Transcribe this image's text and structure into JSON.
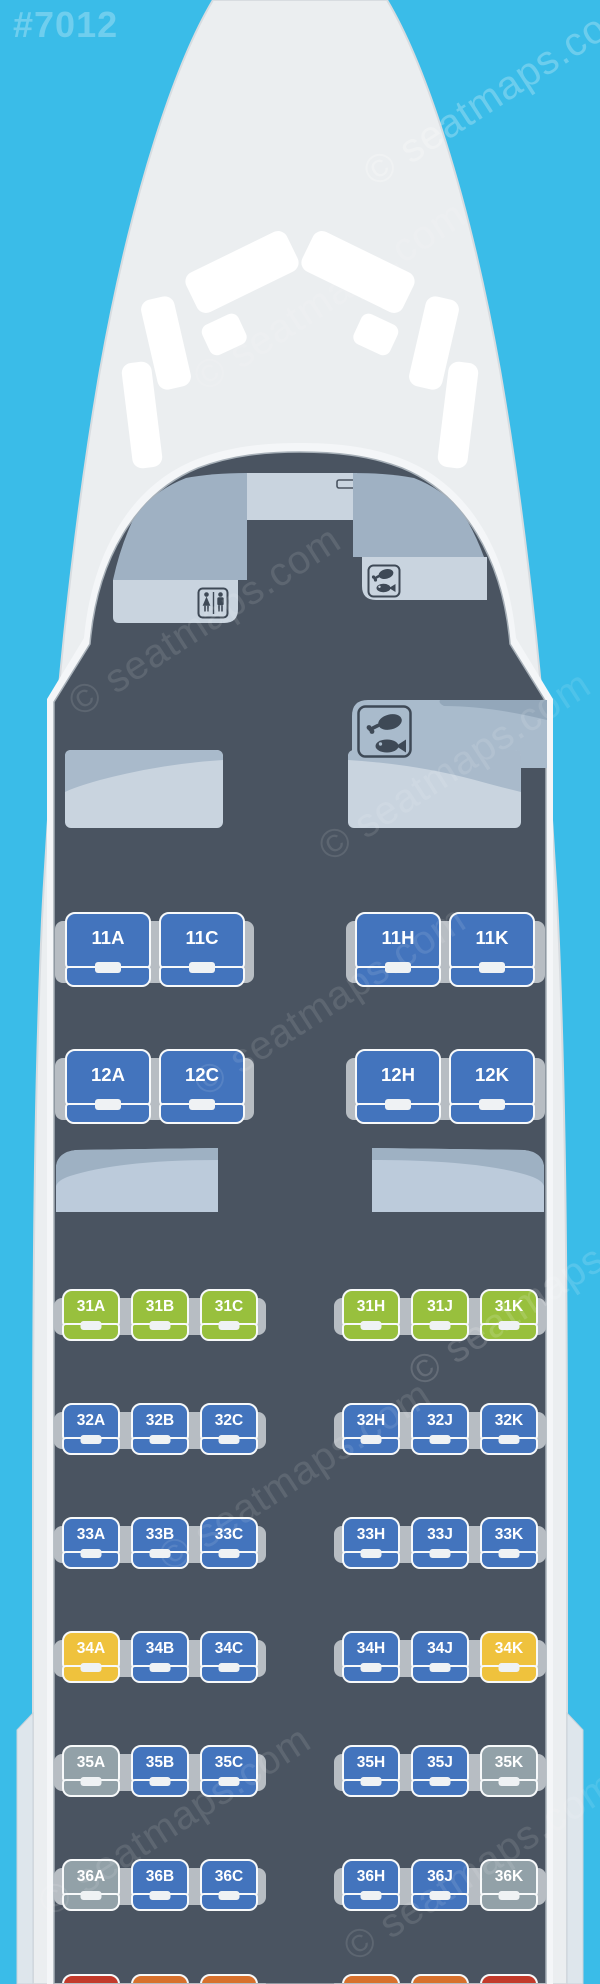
{
  "page": {
    "map_id": "#7012",
    "watermark_text": "© seatmaps.com"
  },
  "palette": {
    "background": "#3ABCE8",
    "fuselage": "#EBEEF0",
    "cabin_floor": "#4A5461",
    "seat_blue": "#4374BD",
    "seat_green": "#98C03D",
    "seat_yellow": "#EFC23D",
    "seat_gray": "#92A1A8",
    "seat_red": "#C23A2B",
    "seat_orange": "#D7712D",
    "armrest": "#B7BDC3",
    "panel_light": "#C9D4DF",
    "panel_medium": "#9FB1C3",
    "icon_ink": "#3E4956"
  },
  "facilities": {
    "cockpit": "cockpit-door",
    "lavatory": "lavatory-front-left",
    "galleys": [
      "galley-front-right",
      "galley-mid-right"
    ]
  },
  "cabin": {
    "business": {
      "layout": "2-2",
      "rows": [
        {
          "row": "11",
          "seats": [
            [
              "11A",
              "blue"
            ],
            [
              "11C",
              "blue"
            ],
            [
              "11H",
              "blue"
            ],
            [
              "11K",
              "blue"
            ]
          ]
        },
        {
          "row": "12",
          "seats": [
            [
              "12A",
              "blue"
            ],
            [
              "12C",
              "blue"
            ],
            [
              "12H",
              "blue"
            ],
            [
              "12K",
              "blue"
            ]
          ]
        }
      ]
    },
    "economy": {
      "layout": "3-3",
      "rows": [
        {
          "row": "31",
          "seats": [
            [
              "31A",
              "green"
            ],
            [
              "31B",
              "green"
            ],
            [
              "31C",
              "green"
            ],
            [
              "31H",
              "green"
            ],
            [
              "31J",
              "green"
            ],
            [
              "31K",
              "green"
            ]
          ]
        },
        {
          "row": "32",
          "seats": [
            [
              "32A",
              "blue"
            ],
            [
              "32B",
              "blue"
            ],
            [
              "32C",
              "blue"
            ],
            [
              "32H",
              "blue"
            ],
            [
              "32J",
              "blue"
            ],
            [
              "32K",
              "blue"
            ]
          ]
        },
        {
          "row": "33",
          "seats": [
            [
              "33A",
              "blue"
            ],
            [
              "33B",
              "blue"
            ],
            [
              "33C",
              "blue"
            ],
            [
              "33H",
              "blue"
            ],
            [
              "33J",
              "blue"
            ],
            [
              "33K",
              "blue"
            ]
          ]
        },
        {
          "row": "34",
          "seats": [
            [
              "34A",
              "yellow"
            ],
            [
              "34B",
              "blue"
            ],
            [
              "34C",
              "blue"
            ],
            [
              "34H",
              "blue"
            ],
            [
              "34J",
              "blue"
            ],
            [
              "34K",
              "yellow"
            ]
          ]
        },
        {
          "row": "35",
          "seats": [
            [
              "35A",
              "gray"
            ],
            [
              "35B",
              "blue"
            ],
            [
              "35C",
              "blue"
            ],
            [
              "35H",
              "blue"
            ],
            [
              "35J",
              "blue"
            ],
            [
              "35K",
              "gray"
            ]
          ]
        },
        {
          "row": "36",
          "seats": [
            [
              "36A",
              "gray"
            ],
            [
              "36B",
              "blue"
            ],
            [
              "36C",
              "blue"
            ],
            [
              "36H",
              "blue"
            ],
            [
              "36J",
              "blue"
            ],
            [
              "36K",
              "gray"
            ]
          ]
        }
      ]
    },
    "partial_next_row": {
      "colors": [
        "red",
        "orange",
        "orange",
        "orange",
        "orange",
        "red"
      ]
    }
  }
}
